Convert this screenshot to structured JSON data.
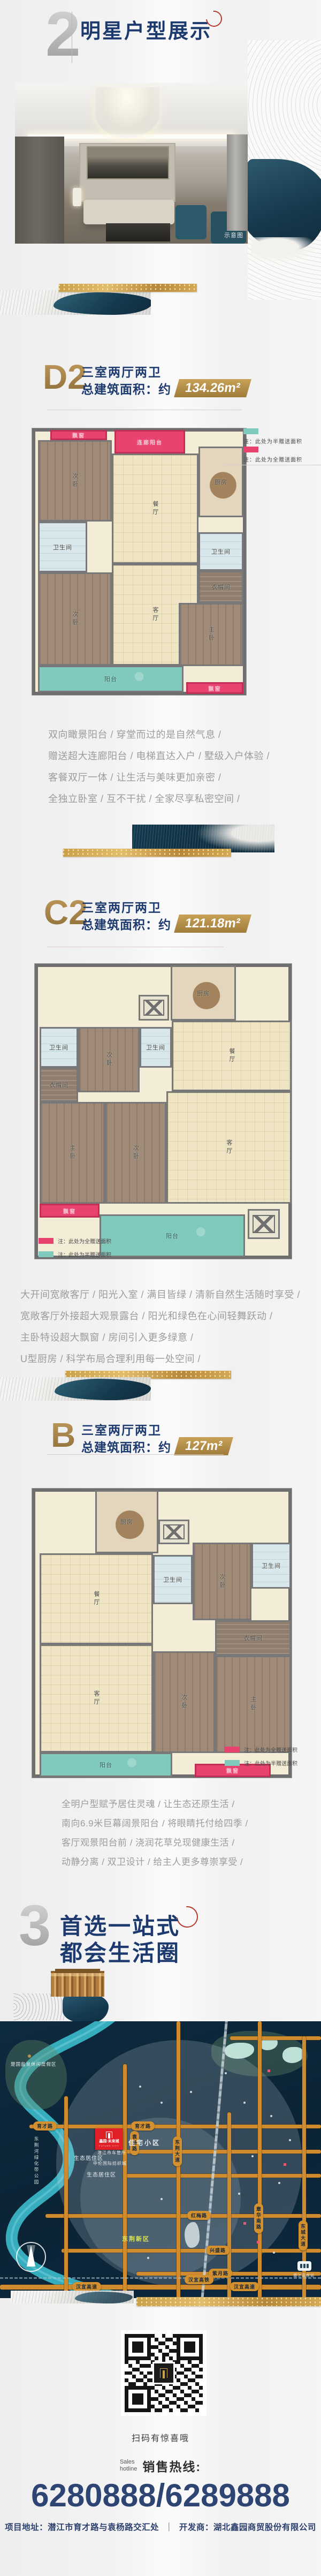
{
  "sections": {
    "plans": {
      "number": "2",
      "title": "明星户型展示"
    },
    "map": {
      "number": "3",
      "title_line1": "首选一站式",
      "title_line2": "都会生活圈"
    }
  },
  "photo": {
    "watermark": "示意图"
  },
  "legend": {
    "half": "注：此处为半赠送面积",
    "full": "注：此处为全赠送面积"
  },
  "units": [
    {
      "code": "D2",
      "layout": "三室两厅两卫",
      "area_prefix": "总建筑面积：约",
      "area": "134.26m²",
      "rooms": {
        "bay_top": "飘窗",
        "corridor_balcony": "连廊阳台",
        "bed_a": "次卧",
        "dining": "餐厅",
        "kitchen": "厨房",
        "bath_a": "卫生间",
        "bed_b": "次卧",
        "living": "客厅",
        "bath_b": "卫生间",
        "cloak": "衣帽间",
        "master": "主卧",
        "balcony": "阳台",
        "bay_bottom": "飘窗"
      },
      "desc": [
        "双向瞰景阳台 / 穿堂而过的是自然气息 /",
        "赠送超大连廊阳台 / 电梯直达入户 / 墅级入户体验 /",
        "客餐双厅一体 / 让生活与美味更加亲密 /",
        "全独立卧室 / 互不干扰 / 全家尽享私密空间 /"
      ]
    },
    {
      "code": "C2",
      "layout": "三室两厅两卫",
      "area_prefix": "总建筑面积：约",
      "area": "121.18m²",
      "rooms": {
        "kitchen": "厨房",
        "bath_a": "卫生间",
        "bed_a": "次卧",
        "bath_b": "卫生间",
        "dining": "餐厅",
        "cloak": "衣帽间",
        "master": "主卧",
        "bed_b": "次卧",
        "living": "客厅",
        "bay": "飘窗",
        "balcony": "阳台"
      },
      "desc": [
        "大开间宽敞客厅 / 阳光入室 / 满目皆绿 / 清新自然生活随时享受 /",
        "宽敞客厅外接超大观景露台 / 阳光和绿色在心间轻舞跃动 /",
        "主卧特设超大飘窗 / 房间引入更多绿意 /",
        "U型厨房 / 科学布局合理利用每一处空间 /"
      ]
    },
    {
      "code": "B",
      "layout": "三室两厅两卫",
      "area_prefix": "总建筑面积：约",
      "area": "127m²",
      "rooms": {
        "kitchen": "厨房",
        "dining": "餐厅",
        "bath_a": "卫生间",
        "bed_a": "次卧",
        "bath_b": "卫生间",
        "living": "客厅",
        "bed_b": "次卧",
        "cloak": "衣帽间",
        "master": "主卧",
        "balcony": "阳台",
        "bay": "飘窗"
      },
      "desc": [
        "全明户型赋予居住灵魂 / 让生态还原生活 /",
        "南向6.9米巨幕阔景阳台 / 将眼睛托付给四季 /",
        "客厅观景阳台前 / 浇润花草兑现健康生活 /",
        "动静分离 / 双卫设计 / 给主人更多尊崇享受 /"
      ]
    }
  ],
  "map": {
    "project_name": "鑫园·未来城",
    "project_en": "FUTURE CITY",
    "roads_h": [
      "育才路",
      "红梅路",
      "兴盛路",
      "紫月路",
      "汉宜高铁",
      "汉宜高速"
    ],
    "roads_v": [
      "袁杨路",
      "东荆大道",
      "章华南路",
      "东城大道"
    ],
    "areas": [
      "住宅小区",
      "生态居住区",
      "生态居住区",
      "东荆新区",
      "东荆河绿化带公园",
      "楚国盐泉休闲度假区"
    ],
    "pois": [
      "潜江市车管所",
      "中伦国际纺织城",
      "潜江高铁站"
    ]
  },
  "footer": {
    "qr_caption": "扫码有惊喜哦",
    "hotline_en_line1": "Sales",
    "hotline_en_line2": "hotline",
    "hotline_zh": "销售热线:",
    "phone": "6280888/6289888",
    "address": "项目地址：潜江市育才路与袁杨路交汇处",
    "separator": "｜",
    "developer": "开发商：湖北鑫园商贸股份有限公司"
  }
}
